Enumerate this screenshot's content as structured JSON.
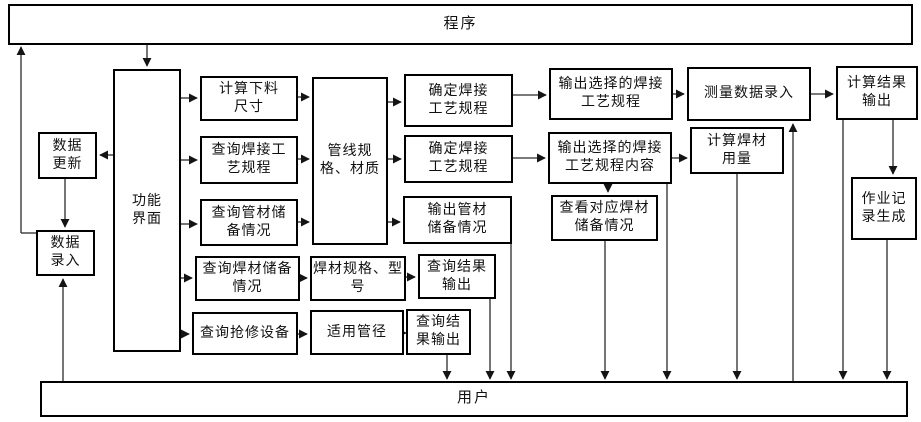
{
  "colors": {
    "box_border": "#000000",
    "box_fill": "#ffffff",
    "connector": "#2b2b2b",
    "text": "#111111"
  },
  "bars": {
    "program": "程序",
    "user": "用户"
  },
  "nodes": {
    "data_update": "数据\n更新",
    "data_entry": "数据\n录入",
    "function_interface": "功能\n界面",
    "calc_cutting_size": "计算下料\n尺寸",
    "query_welding_procedure": "查询焊接工\n艺规程",
    "query_pipe_stock": "查询管材储\n备情况",
    "query_weld_material_stock": "查询焊材储备\n情况",
    "query_repair_equipment": "查询抢修设备",
    "pipeline_spec": "管线规\n格、材质",
    "weld_material_spec": "焊材规格、型\n号",
    "applicable_diameter": "适用管径",
    "determine_welding_procedure_1": "确定焊接\n工艺规程",
    "determine_welding_procedure_2": "确定焊接\n工艺规程",
    "output_pipe_stock": "输出管材\n储备情况",
    "query_result_output_1": "查询结果\n输出",
    "query_result_output_2": "查询结\n果输出",
    "output_selected_procedure": "输出选择的焊接\n工艺规程",
    "output_selected_procedure_content": "输出选择的焊接\n工艺规程内容",
    "view_weld_material_stock": "查看对应焊材\n储备情况",
    "measure_data_entry": "测量数据录入",
    "calc_weld_material_usage": "计算焊材\n用量",
    "calc_result_output": "计算结果\n输出",
    "job_record_generation": "作业记\n录生成"
  }
}
